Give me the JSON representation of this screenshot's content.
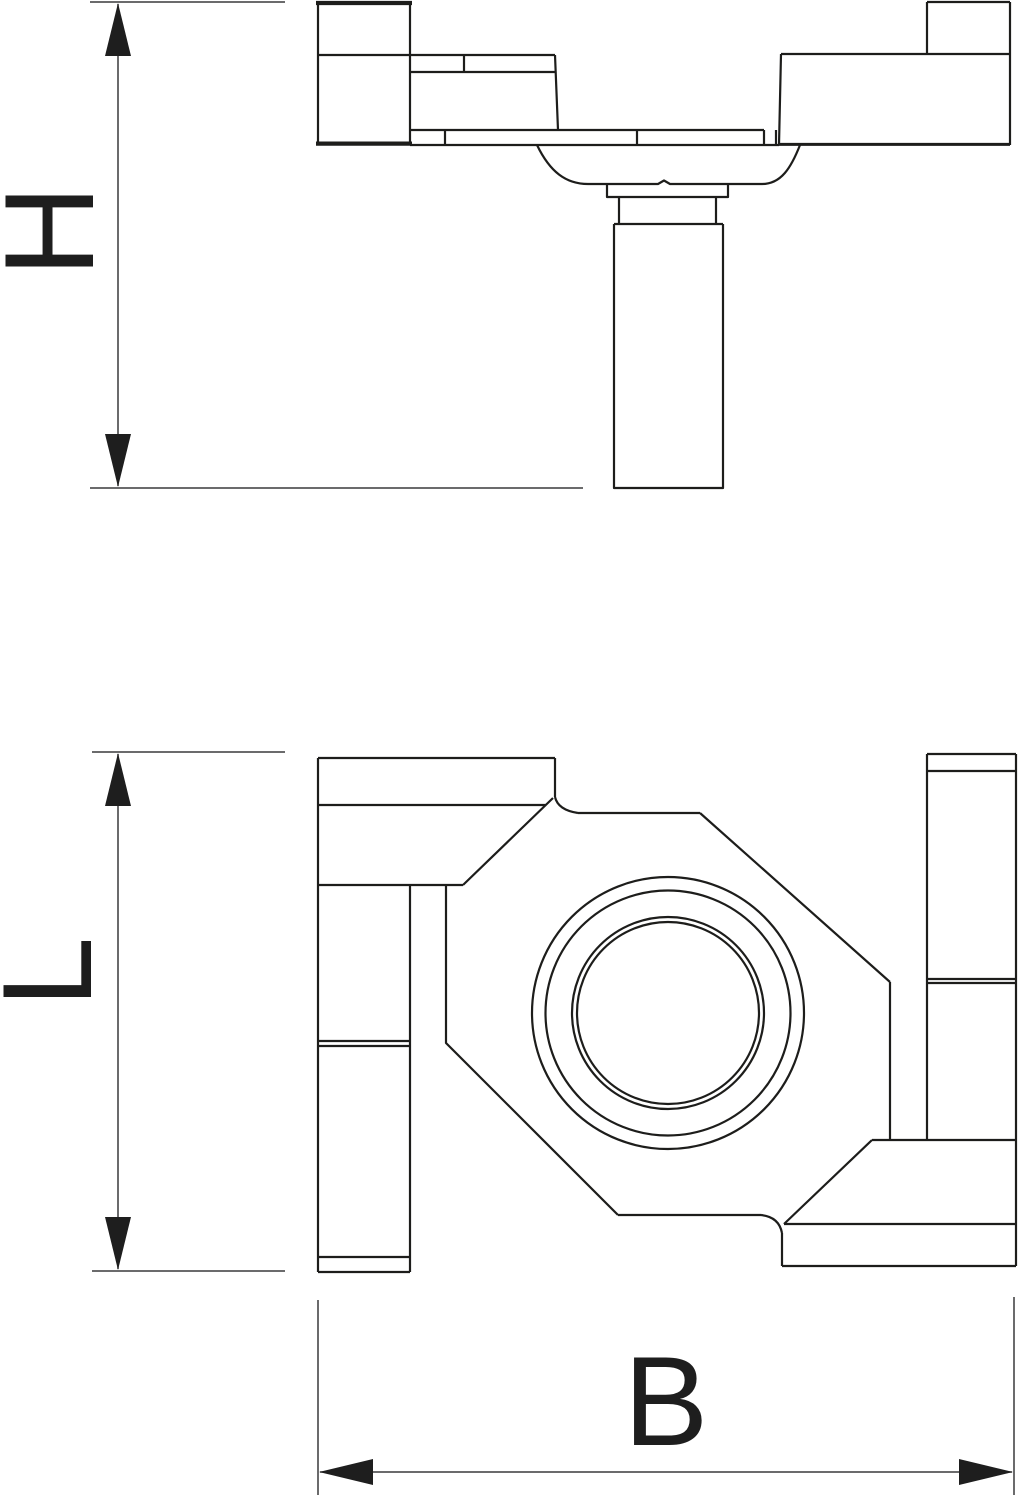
{
  "drawing": {
    "dimension_labels": {
      "height": "H",
      "length": "L",
      "width": "B"
    },
    "colors": {
      "background": "#ffffff",
      "part_line": "#1d1d1b",
      "dimension_line": "#3a3a3b",
      "label_text": "#1e1e1e"
    }
  }
}
